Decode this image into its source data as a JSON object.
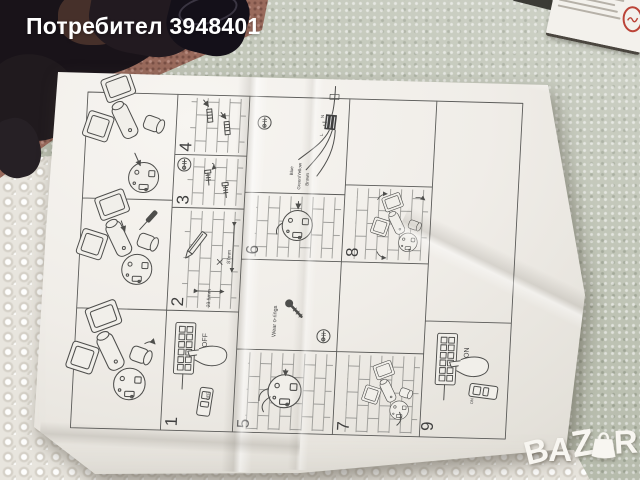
{
  "watermark": {
    "username": "Потребител 3948401"
  },
  "logo": {
    "text": "BAZAR",
    "letters": [
      "B",
      "A",
      "Z",
      "A",
      "R"
    ]
  },
  "sheet": {
    "panel_numbers": [
      "1",
      "2",
      "3",
      "4",
      "5",
      "6",
      "7",
      "8",
      "9"
    ],
    "labels": {
      "power_off": "OFF",
      "power_on": "ON",
      "remote_off": "OFF",
      "remote_on": "ON",
      "wear_orings": "Wear o-rings",
      "dim_height": "87mm",
      "dim_depth": "23.5mm",
      "wire_blue": "Blue",
      "wire_earth": "Green/Yellow",
      "wire_live": "Brown",
      "terminal_neutral": "N",
      "terminal_live": "L"
    }
  },
  "colors": {
    "foam": "#bdc2b3",
    "bubble_wrap": "#e8e5de",
    "carpet": "#996a5c",
    "paper": "#f1efea",
    "line_art": "#4e4e4c",
    "dark_object": "#191419",
    "watermark_text": "#ffffff",
    "logo_text": "#f8f6f1",
    "box_logo_red": "#bb4438"
  }
}
